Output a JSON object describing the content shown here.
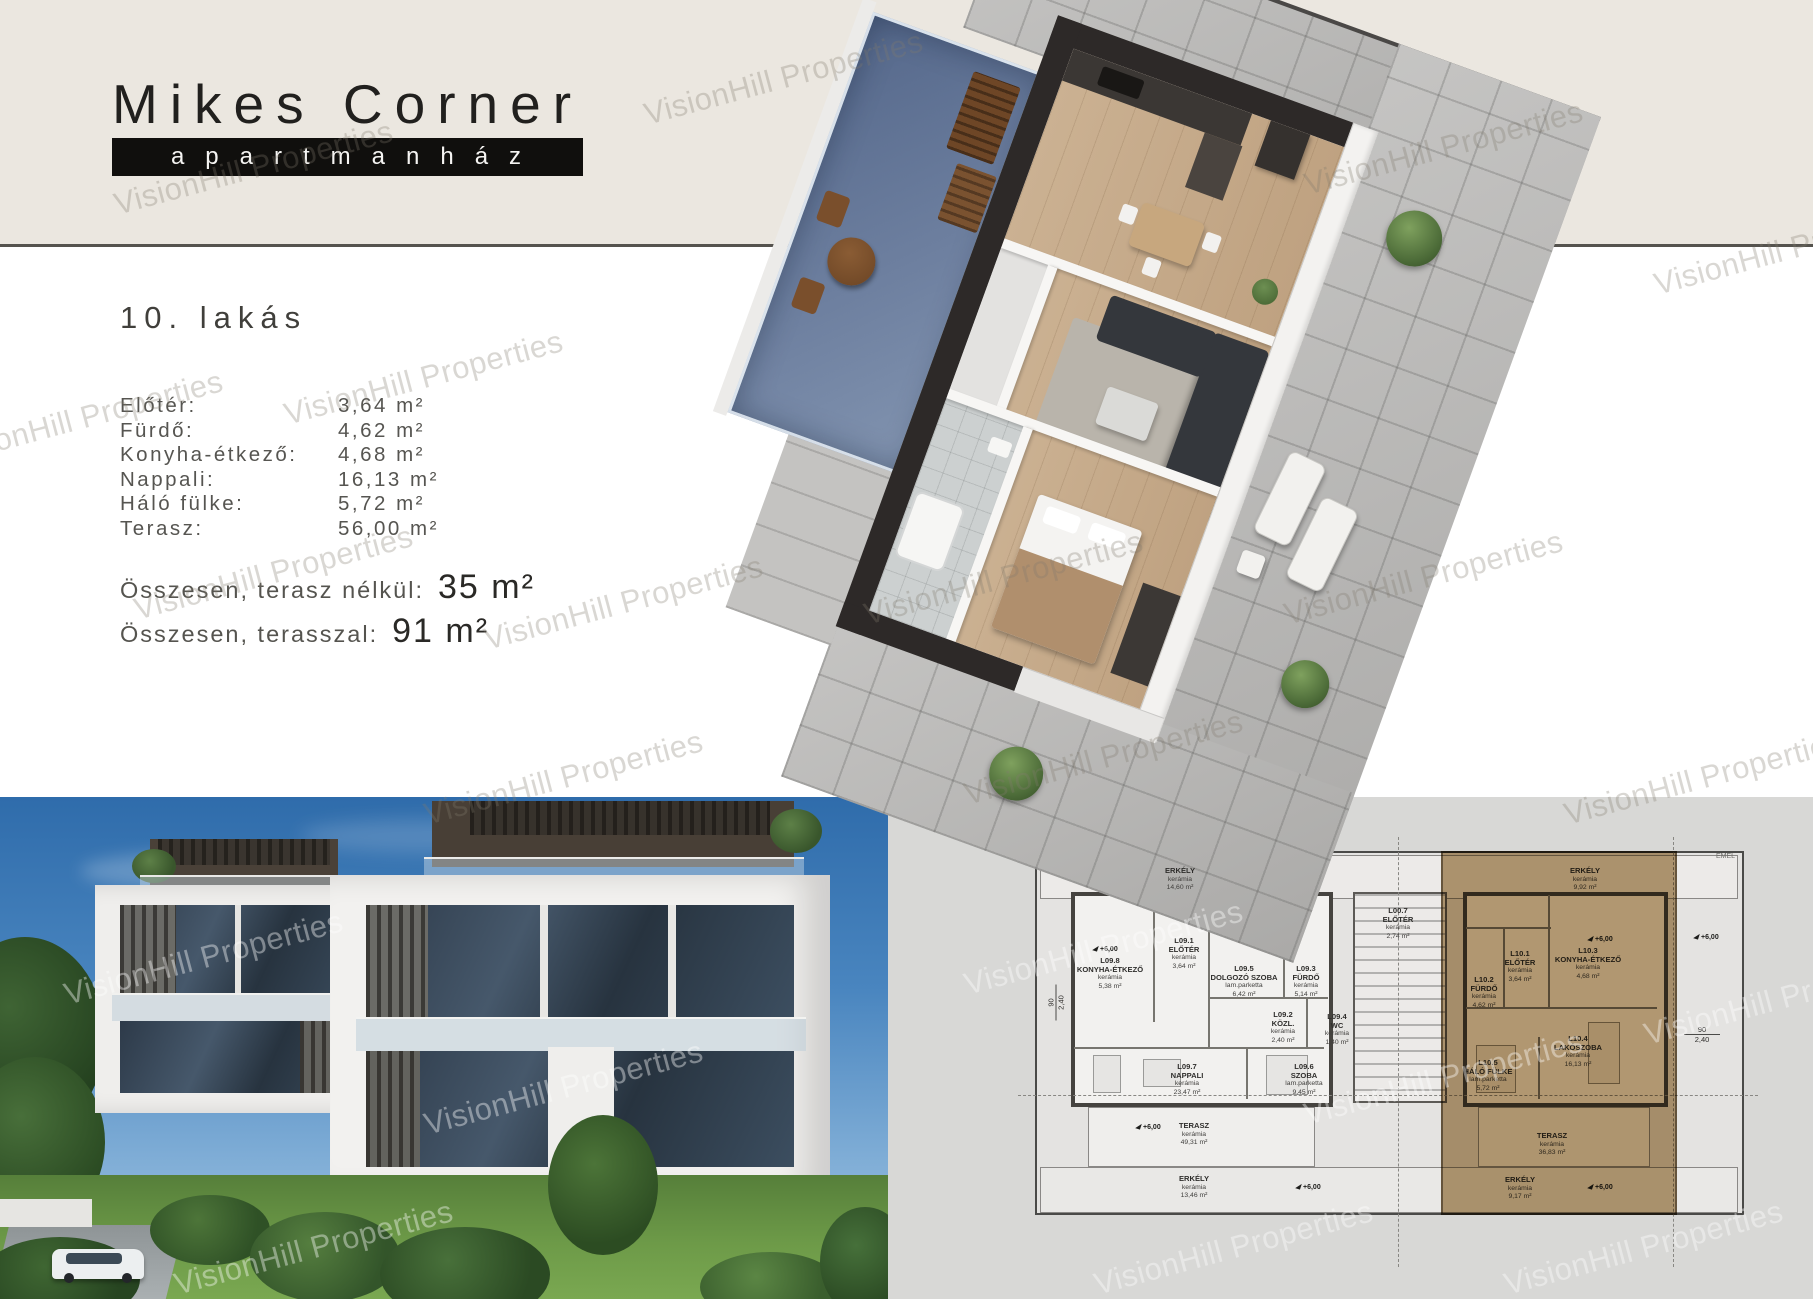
{
  "watermark": "VisionHill Properties",
  "logo": {
    "title": "Mikes Corner",
    "subtitle": "apartmanház"
  },
  "apartment": {
    "heading": "10. lakás",
    "rooms": [
      {
        "label": "Előtér:",
        "value": "3,64 m²"
      },
      {
        "label": "Fürdő:",
        "value": "4,62 m²"
      },
      {
        "label": "Konyha-étkező:",
        "value": "4,68 m²"
      },
      {
        "label": "Nappali:",
        "value": "16,13 m²"
      },
      {
        "label": "Háló fülke:",
        "value": "5,72 m²"
      },
      {
        "label": "Terasz:",
        "value": "56,00 m²"
      }
    ],
    "totals": [
      {
        "label": "Összesen, terasz nélkül:",
        "value": "35 m²"
      },
      {
        "label": "Összesen, terasszal:",
        "value": "91 m²"
      }
    ]
  },
  "floorplan": {
    "note": "EMEL",
    "elevation": "+6,00",
    "dim_a": "90",
    "dim_b": "2,40",
    "stairwell": {
      "code": "L00.7",
      "name": "ELŐTÉR",
      "material": "kerámia",
      "area": "2,74 m²"
    },
    "left_unit": {
      "balcony_top": {
        "name": "ERKÉLY",
        "material": "kerámia",
        "area": "14,60 m²"
      },
      "balcony_bottom": {
        "name": "ERKÉLY",
        "material": "kerámia",
        "area": "13,46 m²"
      },
      "terrace": {
        "name": "TERASZ",
        "material": "kerámia",
        "area": "49,31 m²"
      },
      "rooms": [
        {
          "code": "L09.8",
          "name": "KONYHA-ÉTKEZŐ",
          "material": "kerámia",
          "area": "5,38 m²"
        },
        {
          "code": "L09.1",
          "name": "ELŐTÉR",
          "material": "kerámia",
          "area": "3,64 m²"
        },
        {
          "code": "L09.5",
          "name": "DOLGOZÓ SZOBA",
          "material": "lam.parketta",
          "area": "6,42 m²"
        },
        {
          "code": "L09.3",
          "name": "FÜRDŐ",
          "material": "kerámia",
          "area": "5,14 m²"
        },
        {
          "code": "L09.2",
          "name": "KÖZL.",
          "material": "kerámia",
          "area": "2,40 m²"
        },
        {
          "code": "L09.4",
          "name": "WC",
          "material": "kerámia",
          "area": "1,40 m²"
        },
        {
          "code": "L09.7",
          "name": "NAPPALI",
          "material": "kerámia",
          "area": "23,47 m²"
        },
        {
          "code": "L09.6",
          "name": "SZOBA",
          "material": "lam.parketta",
          "area": "9,45 m²"
        }
      ]
    },
    "right_unit": {
      "balcony_top": {
        "name": "ERKÉLY",
        "material": "kerámia",
        "area": "9,92 m²"
      },
      "balcony_bottom": {
        "name": "ERKÉLY",
        "material": "kerámia",
        "area": "9,17 m²"
      },
      "terrace": {
        "name": "TERASZ",
        "material": "kerámia",
        "area": "36,83 m²"
      },
      "rooms": [
        {
          "code": "L10.1",
          "name": "ELŐTÉR",
          "material": "kerámia",
          "area": "3,64 m²"
        },
        {
          "code": "L10.2",
          "name": "FÜRDŐ",
          "material": "kerámia",
          "area": "4,62 m²"
        },
        {
          "code": "L10.3",
          "name": "KONYHA-ÉTKEZŐ",
          "material": "kerámia",
          "area": "4,68 m²"
        },
        {
          "code": "L10.5",
          "name": "HÁLÓ FÜLKE",
          "material": "lam.parketta",
          "area": "5,72 m²"
        },
        {
          "code": "L10.4",
          "name": "LAKÓSZOBA",
          "material": "kerámia",
          "area": "16,13 m²"
        }
      ]
    }
  }
}
